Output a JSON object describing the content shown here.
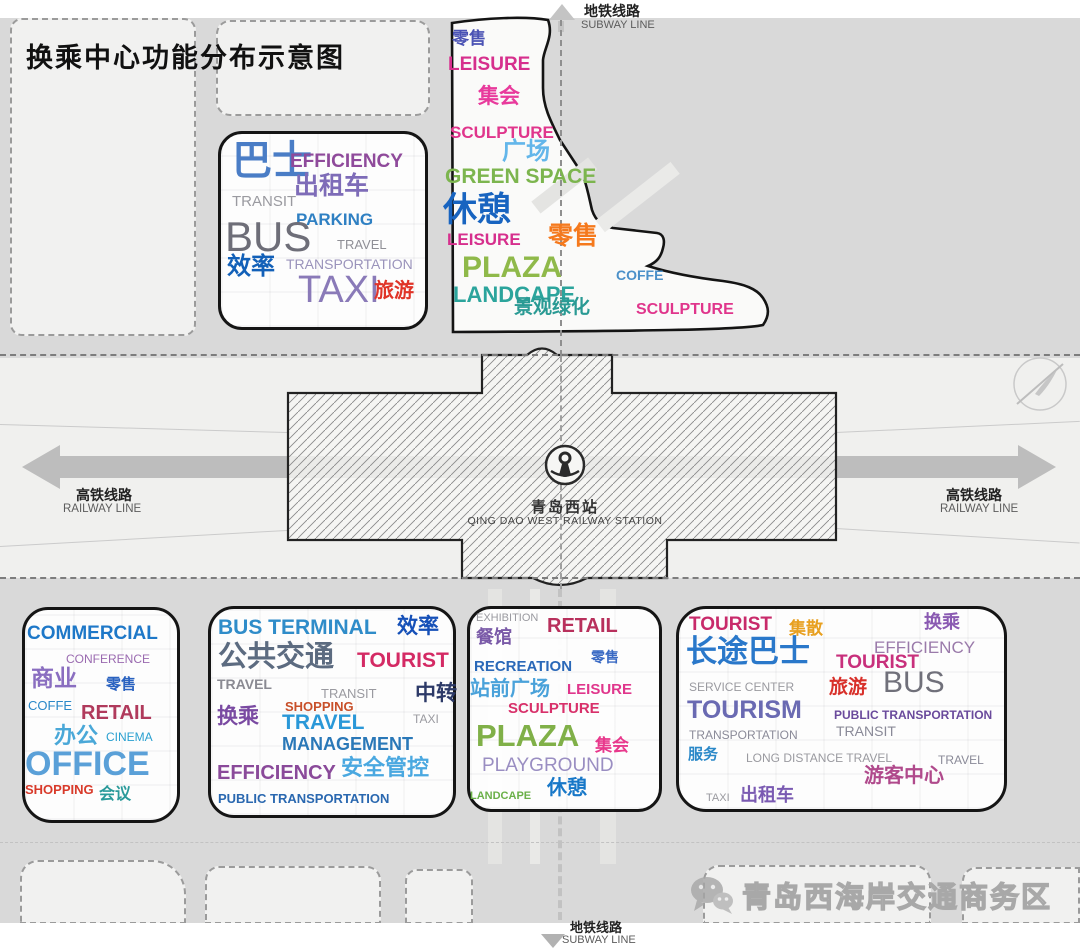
{
  "title": "换乘中心功能分布示意图",
  "station": {
    "logo": "china-railway-logo",
    "name_cn": "青岛西站",
    "name_en": "QING DAO WEST RAILWAY STATION"
  },
  "subway": {
    "top_cn": "地铁线路",
    "top_en": "SUBWAY LINE",
    "bottom_cn": "地铁线路",
    "bottom_en": "SUBWAY LINE"
  },
  "railway": {
    "left_cn": "高铁线路",
    "left_en": "RAILWAY LINE",
    "right_cn": "高铁线路",
    "right_en": "RAILWAY LINE"
  },
  "watermark": {
    "icon": "wechat-icon",
    "text": "青岛西海岸交通商务区"
  },
  "zones": [
    {
      "name": "transit-hub-nw",
      "words": [
        {
          "t": "巴士",
          "c": "#4a7dc6",
          "s": 40,
          "fw": 900,
          "x": 14,
          "y": 10
        },
        {
          "t": "EFFICIENCY",
          "c": "#8f4a9b",
          "s": 19,
          "fw": 600,
          "x": 72,
          "y": 21
        },
        {
          "t": "出租车",
          "c": "#7e6cb8",
          "s": 25,
          "fw": 800,
          "x": 76,
          "y": 43
        },
        {
          "t": "TRANSIT",
          "c": "#9a9aa0",
          "s": 15,
          "fw": 500,
          "x": 14,
          "y": 63
        },
        {
          "t": "PARKING",
          "c": "#2f80c3",
          "s": 17,
          "fw": 600,
          "x": 78,
          "y": 80
        },
        {
          "t": "BUS",
          "c": "#6e6e78",
          "s": 42,
          "fw": 500,
          "x": 7,
          "y": 85
        },
        {
          "t": "TRAVEL",
          "c": "#8f8f96",
          "s": 13,
          "fw": 500,
          "x": 119,
          "y": 107
        },
        {
          "t": "TRANSPORTATION",
          "c": "#9a93bb",
          "s": 14,
          "fw": 500,
          "x": 68,
          "y": 126
        },
        {
          "t": "效率",
          "c": "#1260b8",
          "s": 24,
          "fw": 900,
          "x": 9,
          "y": 124
        },
        {
          "t": "TAXI",
          "c": "#8a7ab8",
          "s": 38,
          "fw": 500,
          "x": 80,
          "y": 140
        },
        {
          "t": "旅游",
          "c": "#e03428",
          "s": 20,
          "fw": 900,
          "x": 156,
          "y": 150
        }
      ]
    },
    {
      "name": "plaza-leisure-n",
      "words": [
        {
          "t": "零售",
          "c": "#4a52b4",
          "s": 17,
          "fw": 800,
          "x": 12,
          "y": 20
        },
        {
          "t": "LEISURE",
          "c": "#d62f8d",
          "s": 19,
          "fw": 700,
          "x": 8,
          "y": 45
        },
        {
          "t": "集会",
          "c": "#e83a9c",
          "s": 21,
          "fw": 800,
          "x": 38,
          "y": 76
        },
        {
          "t": "SCULPTURE",
          "c": "#e0358c",
          "s": 17,
          "fw": 700,
          "x": 10,
          "y": 114
        },
        {
          "t": "广场",
          "c": "#63b6ea",
          "s": 24,
          "fw": 800,
          "x": 62,
          "y": 130
        },
        {
          "t": "GREEN SPACE",
          "c": "#7cb54e",
          "s": 21,
          "fw": 800,
          "x": 5,
          "y": 156
        },
        {
          "t": "休憩",
          "c": "#1864c0",
          "s": 34,
          "fw": 900,
          "x": 3,
          "y": 183
        },
        {
          "t": "LEISURE",
          "c": "#d62f8d",
          "s": 17,
          "fw": 700,
          "x": 7,
          "y": 221
        },
        {
          "t": "零售",
          "c": "#f5791d",
          "s": 25,
          "fw": 900,
          "x": 108,
          "y": 214
        },
        {
          "t": "PLAZA",
          "c": "#8fb94a",
          "s": 30,
          "fw": 800,
          "x": 22,
          "y": 243
        },
        {
          "t": "LANDCAPE",
          "c": "#2ba49c",
          "s": 22,
          "fw": 700,
          "x": 13,
          "y": 274
        },
        {
          "t": "COFFE",
          "c": "#4b90c9",
          "s": 14,
          "fw": 600,
          "x": 176,
          "y": 258
        },
        {
          "t": "景观绿化",
          "c": "#2a9a94",
          "s": 19,
          "fw": 800,
          "x": 74,
          "y": 288
        },
        {
          "t": "SCULPTURE",
          "c": "#e0358c",
          "s": 16,
          "fw": 700,
          "x": 196,
          "y": 292
        }
      ]
    },
    {
      "name": "commercial-sw",
      "words": [
        {
          "t": "COMMERCIAL",
          "c": "#1e78c8",
          "s": 19,
          "fw": 800,
          "x": 5,
          "y": 17
        },
        {
          "t": "CONFERENCE",
          "c": "#9a6ab0",
          "s": 12,
          "fw": 500,
          "x": 44,
          "y": 46
        },
        {
          "t": "商业",
          "c": "#8a6ec0",
          "s": 23,
          "fw": 800,
          "x": 9,
          "y": 60
        },
        {
          "t": "零售",
          "c": "#2a62c0",
          "s": 15,
          "fw": 800,
          "x": 84,
          "y": 70
        },
        {
          "t": "COFFE",
          "c": "#2a88c8",
          "s": 13,
          "fw": 500,
          "x": 6,
          "y": 92
        },
        {
          "t": "RETAIL",
          "c": "#b03a5c",
          "s": 20,
          "fw": 800,
          "x": 59,
          "y": 96
        },
        {
          "t": "办公",
          "c": "#4aa8d8",
          "s": 22,
          "fw": 800,
          "x": 32,
          "y": 118
        },
        {
          "t": "CINEMA",
          "c": "#2aa0d0",
          "s": 12,
          "fw": 500,
          "x": 84,
          "y": 124
        },
        {
          "t": "OFFICE",
          "c": "#5aa0d8",
          "s": 34,
          "fw": 600,
          "x": 3,
          "y": 140
        },
        {
          "t": "SHOPPING",
          "c": "#d83a2a",
          "s": 13,
          "fw": 700,
          "x": 3,
          "y": 176
        },
        {
          "t": "会议",
          "c": "#2a9a9a",
          "s": 16,
          "fw": 600,
          "x": 77,
          "y": 180
        }
      ]
    },
    {
      "name": "bus-terminal-s",
      "words": [
        {
          "t": "BUS TERMINAL",
          "c": "#2f8cc9",
          "s": 21,
          "fw": 600,
          "x": 10,
          "y": 11
        },
        {
          "t": "效率",
          "c": "#1550b8",
          "s": 21,
          "fw": 900,
          "x": 189,
          "y": 10
        },
        {
          "t": "公共交通",
          "c": "#5c6b80",
          "s": 29,
          "fw": 900,
          "x": 10,
          "y": 37
        },
        {
          "t": "TOURIST",
          "c": "#d42a64",
          "s": 21,
          "fw": 800,
          "x": 149,
          "y": 44
        },
        {
          "t": "TRAVEL",
          "c": "#8a8a92",
          "s": 14,
          "fw": 600,
          "x": 9,
          "y": 71
        },
        {
          "t": "TRANSIT",
          "c": "#9a9aa0",
          "s": 13,
          "fw": 500,
          "x": 113,
          "y": 81
        },
        {
          "t": "中转",
          "c": "#2d3a68",
          "s": 21,
          "fw": 900,
          "x": 207,
          "y": 77
        },
        {
          "t": "SHOPPING",
          "c": "#c8502a",
          "s": 13,
          "fw": 700,
          "x": 77,
          "y": 94
        },
        {
          "t": "换乘",
          "c": "#7a4aa2",
          "s": 21,
          "fw": 800,
          "x": 9,
          "y": 100
        },
        {
          "t": "TRAVEL",
          "c": "#2a98d8",
          "s": 21,
          "fw": 600,
          "x": 74,
          "y": 106
        },
        {
          "t": "TAXI",
          "c": "#9a9aa0",
          "s": 12,
          "fw": 500,
          "x": 205,
          "y": 107
        },
        {
          "t": "MANAGEMENT",
          "c": "#2a78b8",
          "s": 18,
          "fw": 600,
          "x": 74,
          "y": 129
        },
        {
          "t": "EFFICIENCY",
          "c": "#8a4a9a",
          "s": 20,
          "fw": 600,
          "x": 9,
          "y": 157
        },
        {
          "t": "安全管控",
          "c": "#4aa8e0",
          "s": 22,
          "fw": 800,
          "x": 133,
          "y": 151
        },
        {
          "t": "PUBLIC TRANSPORTATION",
          "c": "#2a68b0",
          "s": 13,
          "fw": 600,
          "x": 10,
          "y": 186
        }
      ]
    },
    {
      "name": "station-plaza-s",
      "words": [
        {
          "t": "EXHIBITION",
          "c": "#9a9aa0",
          "s": 11,
          "fw": 500,
          "x": 9,
          "y": 7
        },
        {
          "t": "RETAIL",
          "c": "#b8305c",
          "s": 20,
          "fw": 800,
          "x": 80,
          "y": 10
        },
        {
          "t": "餐馆",
          "c": "#7a5aa8",
          "s": 18,
          "fw": 800,
          "x": 9,
          "y": 22
        },
        {
          "t": "零售",
          "c": "#3a6ac4",
          "s": 14,
          "fw": 700,
          "x": 124,
          "y": 44
        },
        {
          "t": "RECREATION",
          "c": "#2a68b8",
          "s": 15,
          "fw": 600,
          "x": 7,
          "y": 53
        },
        {
          "t": "站前广场",
          "c": "#4aa2da",
          "s": 20,
          "fw": 900,
          "x": 3,
          "y": 73
        },
        {
          "t": "LEISURE",
          "c": "#e0368c",
          "s": 15,
          "fw": 600,
          "x": 100,
          "y": 76
        },
        {
          "t": "SCULPTURE",
          "c": "#d8306a",
          "s": 15,
          "fw": 600,
          "x": 41,
          "y": 95
        },
        {
          "t": "PLAZA",
          "c": "#80b048",
          "s": 31,
          "fw": 800,
          "x": 9,
          "y": 114
        },
        {
          "t": "集会",
          "c": "#e8388c",
          "s": 17,
          "fw": 800,
          "x": 128,
          "y": 131
        },
        {
          "t": "PLAYGROUND",
          "c": "#9a8ec2",
          "s": 19,
          "fw": 500,
          "x": 15,
          "y": 150
        },
        {
          "t": "LANDCAPE",
          "c": "#6ab048",
          "s": 11,
          "fw": 600,
          "x": 3,
          "y": 185
        },
        {
          "t": "休憩",
          "c": "#1878c8",
          "s": 20,
          "fw": 900,
          "x": 80,
          "y": 172
        }
      ]
    },
    {
      "name": "coach-tourist-se",
      "words": [
        {
          "t": "TOURIST",
          "c": "#c82a6a",
          "s": 19,
          "fw": 800,
          "x": 13,
          "y": 9
        },
        {
          "t": "集散",
          "c": "#e8a020",
          "s": 17,
          "fw": 900,
          "x": 113,
          "y": 14
        },
        {
          "t": "换乘",
          "c": "#8a5ab2",
          "s": 18,
          "fw": 800,
          "x": 248,
          "y": 7
        },
        {
          "t": "长途巴士",
          "c": "#2a78ca",
          "s": 31,
          "fw": 900,
          "x": 10,
          "y": 30
        },
        {
          "t": "EFFICIENCY",
          "c": "#9a7aaa",
          "s": 17,
          "fw": 500,
          "x": 198,
          "y": 33
        },
        {
          "t": "TOURIST",
          "c": "#c8307c",
          "s": 19,
          "fw": 800,
          "x": 160,
          "y": 47
        },
        {
          "t": "SERVICE CENTER",
          "c": "#9a9aa0",
          "s": 12,
          "fw": 500,
          "x": 13,
          "y": 75
        },
        {
          "t": "旅游",
          "c": "#d8302a",
          "s": 19,
          "fw": 900,
          "x": 153,
          "y": 72
        },
        {
          "t": "BUS",
          "c": "#70707a",
          "s": 30,
          "fw": 500,
          "x": 207,
          "y": 62
        },
        {
          "t": "TOURISM",
          "c": "#6a6ab2",
          "s": 25,
          "fw": 600,
          "x": 11,
          "y": 92
        },
        {
          "t": "PUBLIC TRANSPORTATION",
          "c": "#6a4a9c",
          "s": 12,
          "fw": 600,
          "x": 158,
          "y": 103
        },
        {
          "t": "TRANSPORTATION",
          "c": "#8a8a98",
          "s": 12,
          "fw": 500,
          "x": 13,
          "y": 123
        },
        {
          "t": "TRANSIT",
          "c": "#8a8a98",
          "s": 14,
          "fw": 500,
          "x": 160,
          "y": 118
        },
        {
          "t": "服务",
          "c": "#2a88c8",
          "s": 15,
          "fw": 800,
          "x": 12,
          "y": 141
        },
        {
          "t": "LONG DISTANCE TRAVEL",
          "c": "#9a9aa0",
          "s": 12,
          "fw": 500,
          "x": 70,
          "y": 146
        },
        {
          "t": "TRAVEL",
          "c": "#8a8a98",
          "s": 12,
          "fw": 500,
          "x": 262,
          "y": 148
        },
        {
          "t": "游客中心",
          "c": "#b04a8c",
          "s": 20,
          "fw": 900,
          "x": 188,
          "y": 160
        },
        {
          "t": "TAXI",
          "c": "#9a9aa0",
          "s": 11,
          "fw": 500,
          "x": 30,
          "y": 187
        },
        {
          "t": "出租车",
          "c": "#7a5ab2",
          "s": 18,
          "fw": 800,
          "x": 64,
          "y": 180
        }
      ]
    }
  ]
}
